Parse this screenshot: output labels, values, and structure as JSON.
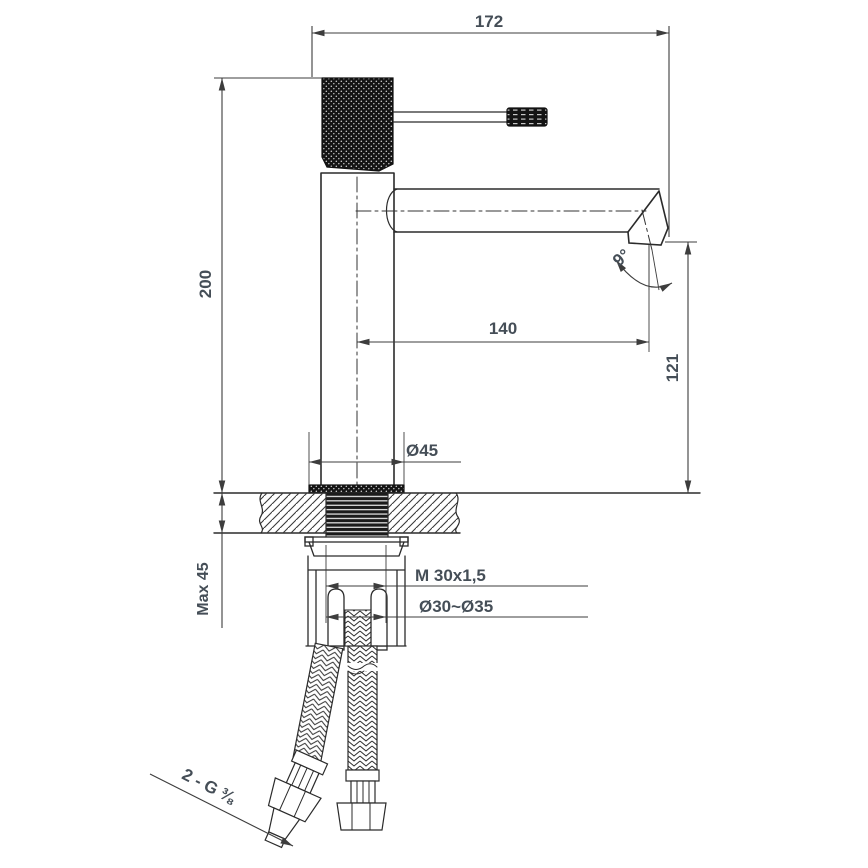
{
  "meta": {
    "subject": "Single-lever basin mixer tap — side elevation technical drawing with installation cross-section"
  },
  "colors": {
    "background": "#ffffff",
    "object_line": "#2b2b2b",
    "dimension_line": "#3d3d3d",
    "text": "#454e57"
  },
  "labels": {
    "top_width": "172",
    "total_height": "200",
    "spout_reach": "140",
    "outlet_height": "121",
    "outlet_angle": "9°",
    "base_diameter": "Ø45",
    "max_counter_thickness": "Max 45",
    "mounting_thread": "M 30x1,5",
    "hole_diameter": "Ø30~Ø35",
    "supply_hoses": "2 - G ⅜"
  }
}
